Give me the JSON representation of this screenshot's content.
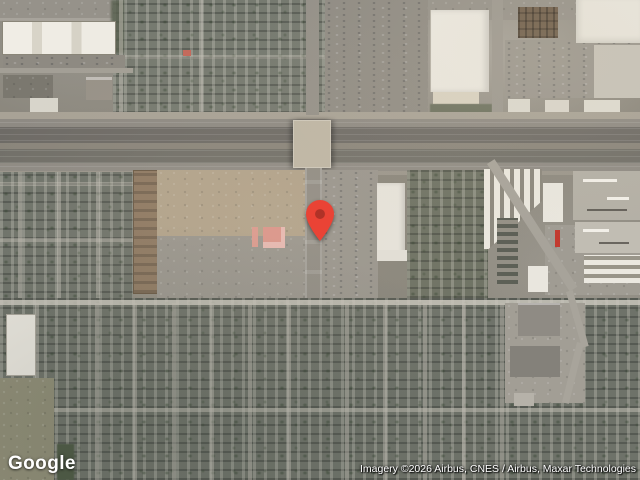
{
  "map": {
    "view": "satellite",
    "logo_text": "Google",
    "attribution_text": "Imagery ©2026 Airbus, CNES / Airbus, Maxar Technologies",
    "marker": {
      "color": "#EA4335",
      "dot_color": "#B03227"
    }
  }
}
